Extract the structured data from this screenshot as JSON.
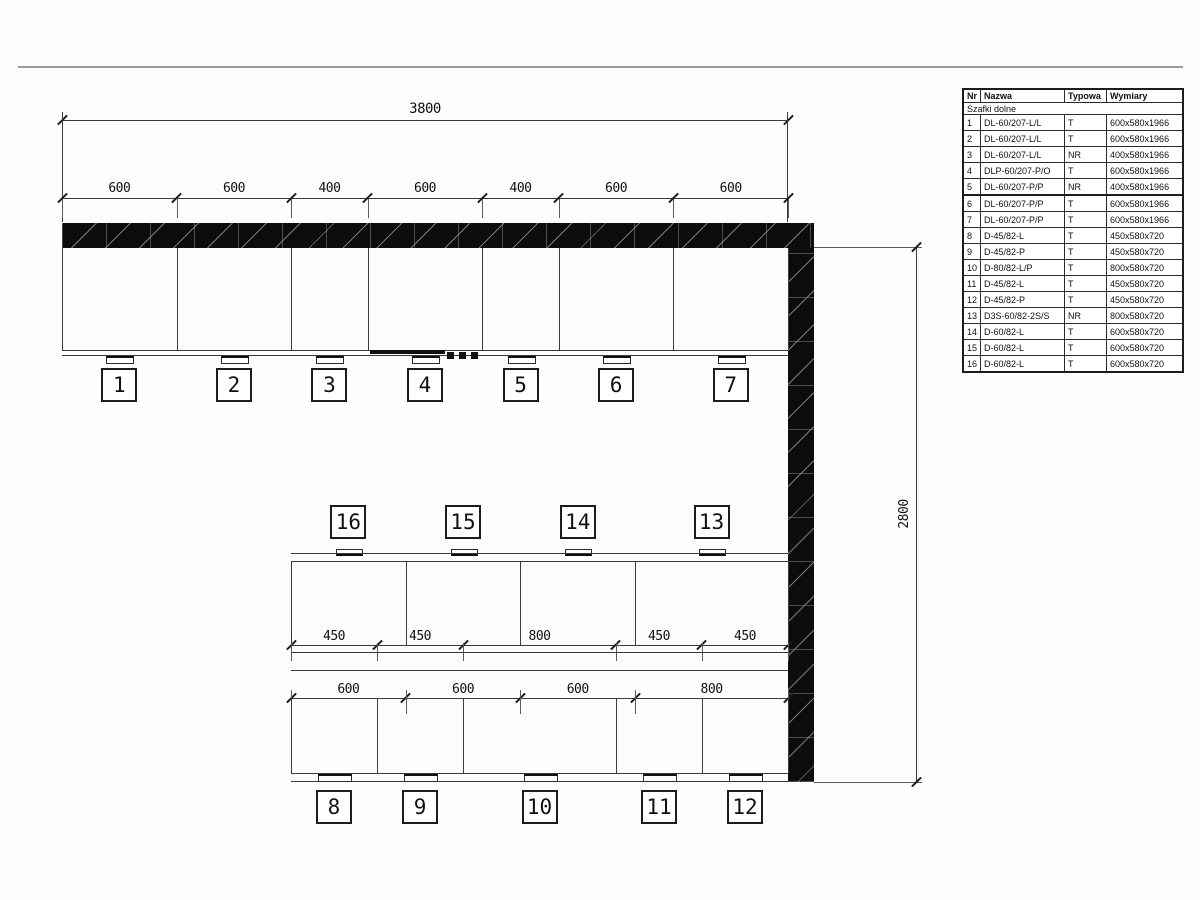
{
  "drawing": {
    "top_run": {
      "overall_width_label": "3800",
      "segment_labels": [
        "600",
        "600",
        "400",
        "600",
        "400",
        "600",
        "600"
      ],
      "segments_mm": [
        600,
        600,
        400,
        600,
        400,
        600,
        600
      ],
      "cabinet_numbers": [
        "1",
        "2",
        "3",
        "4",
        "5",
        "6",
        "7"
      ]
    },
    "right_dim": {
      "height_label": "2800"
    },
    "bottom_run": {
      "upper_segment_labels": [
        "600",
        "600",
        "600",
        "800"
      ],
      "upper_segments_mm": [
        600,
        600,
        600,
        800
      ],
      "upper_cabinet_numbers": [
        "16",
        "15",
        "14",
        "13"
      ],
      "lower_segment_labels": [
        "450",
        "450",
        "800",
        "450",
        "450"
      ],
      "lower_segments_mm": [
        450,
        450,
        800,
        450,
        450
      ],
      "lower_cabinet_numbers": [
        "8",
        "9",
        "10",
        "11",
        "12"
      ]
    }
  },
  "table": {
    "headers": [
      "Nr",
      "Nazwa",
      "Typowa",
      "Wymiary"
    ],
    "section_title": "Szafki dolne",
    "rows": [
      {
        "nr": "1",
        "nazwa": "DL-60/207-L/L",
        "typowa": "T",
        "wymiary": "600x580x1966",
        "bold": false
      },
      {
        "nr": "2",
        "nazwa": "DL-60/207-L/L",
        "typowa": "T",
        "wymiary": "600x580x1966",
        "bold": false
      },
      {
        "nr": "3",
        "nazwa": "DL-60/207-L/L",
        "typowa": "NR",
        "wymiary": "400x580x1966",
        "bold": true
      },
      {
        "nr": "4",
        "nazwa": "DLP-60/207-P/O",
        "typowa": "T",
        "wymiary": "600x580x1966",
        "bold": false
      },
      {
        "nr": "5",
        "nazwa": "DL-60/207-P/P",
        "typowa": "NR",
        "wymiary": "400x580x1966",
        "bold": true
      },
      {
        "nr": "6",
        "nazwa": "DL-60/207-P/P",
        "typowa": "T",
        "wymiary": "600x580x1966",
        "bold": false
      },
      {
        "nr": "7",
        "nazwa": "DL-60/207-P/P",
        "typowa": "T",
        "wymiary": "600x580x1966",
        "bold": false
      },
      {
        "nr": "8",
        "nazwa": "D-45/82-L",
        "typowa": "T",
        "wymiary": "450x580x720",
        "bold": false
      },
      {
        "nr": "9",
        "nazwa": "D-45/82-P",
        "typowa": "T",
        "wymiary": "450x580x720",
        "bold": false
      },
      {
        "nr": "10",
        "nazwa": "D-80/82-L/P",
        "typowa": "T",
        "wymiary": "800x580x720",
        "bold": false
      },
      {
        "nr": "11",
        "nazwa": "D-45/82-L",
        "typowa": "T",
        "wymiary": "450x580x720",
        "bold": false
      },
      {
        "nr": "12",
        "nazwa": "D-45/82-P",
        "typowa": "T",
        "wymiary": "450x580x720",
        "bold": false
      },
      {
        "nr": "13",
        "nazwa": "D3S-60/82-2S/S",
        "typowa": "NR",
        "wymiary": "800x580x720",
        "bold": true
      },
      {
        "nr": "14",
        "nazwa": "D-60/82-L",
        "typowa": "T",
        "wymiary": "600x580x720",
        "bold": false
      },
      {
        "nr": "15",
        "nazwa": "D-60/82-L",
        "typowa": "T",
        "wymiary": "600x580x720",
        "bold": false
      },
      {
        "nr": "16",
        "nazwa": "D-60/82-L",
        "typowa": "T",
        "wymiary": "600x580x720",
        "bold": false
      }
    ]
  }
}
